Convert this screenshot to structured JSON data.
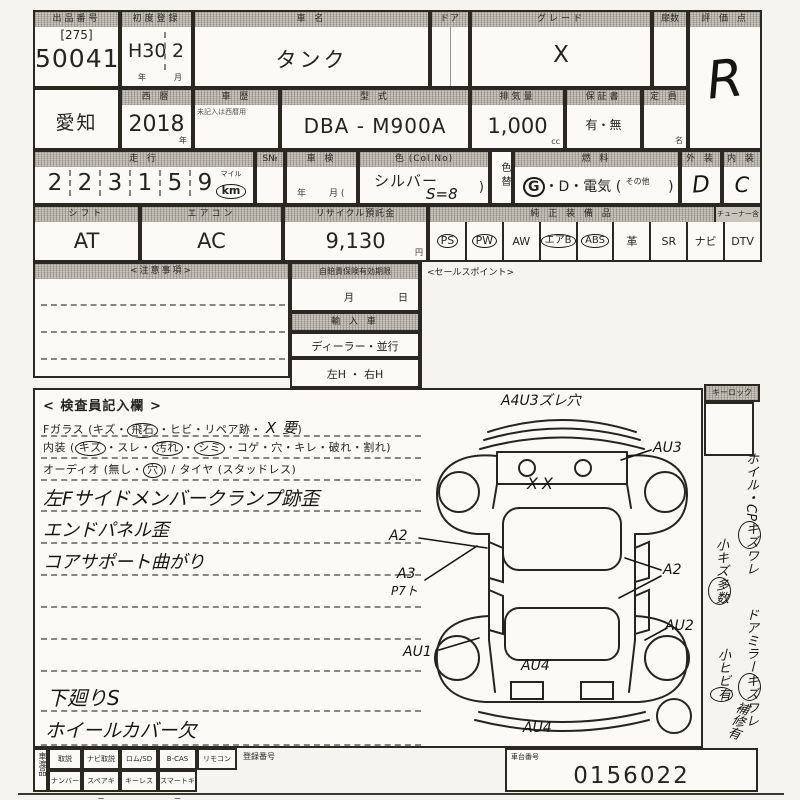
{
  "palette": {
    "ink": "#2b2822",
    "paper": "#f5f4ef",
    "cell": "#fbfaf6",
    "header_gray": "#c9c5bd",
    "handwriting": "#17150f"
  },
  "row1": {
    "auction_label": "出品番号",
    "auction_bracket": "[275]",
    "auction_no": "50041",
    "firstreg_label": "初度登録",
    "firstreg_year": "H30",
    "firstreg_month": "2",
    "year_unit": "年",
    "month_unit": "月",
    "carname_label": "車 名",
    "carname": "タンク",
    "door_label": "ドア",
    "grade_label": "グレード",
    "grade": "X",
    "doors_label": "扉数",
    "score_label": "評 価 点",
    "score": "R"
  },
  "row2": {
    "prefecture": "愛知",
    "seireki_label": "西 暦",
    "seireki": "2018",
    "year_unit": "年",
    "rireki_label": "車 歴",
    "rireki_note": "未記入は西暦用",
    "model_label": "型 式",
    "model": "DBA - M900A",
    "disp_label": "排気量",
    "disp": "1,000",
    "cc": "cc",
    "warranty_label": "保証書",
    "warranty": "有・無",
    "capacity_label": "定 員",
    "capacity_unit": "名"
  },
  "row3": {
    "mileage_label": "走 行",
    "digits": [
      "2",
      "2",
      "3",
      "1",
      "5",
      "9"
    ],
    "mile": "マイル",
    "km": "km",
    "s_label": "S№",
    "shaken_label": "車 検",
    "shaken_y": "年",
    "shaken_m": "月 (",
    "color_label": "色 (Col.No)",
    "color": "シルバー",
    "color_no": "S=8",
    "paren": ")",
    "colorchg_label": "色替",
    "fuel_label": "燃 料",
    "fuel_g": "G",
    "fuel_rest": "・D・電気 (",
    "fuel_other": "その他",
    "fuel_close": ")",
    "ext_label": "外 装",
    "ext": "D",
    "int_label": "内 装",
    "int": "C"
  },
  "row4": {
    "shift_label": "シフト",
    "shift": "AT",
    "aircon_label": "エアコン",
    "aircon": "AC",
    "recycle_label": "リサイクル預託金",
    "recycle": "9,130",
    "yen": "円",
    "equip_label": "純 正 装 備 品",
    "tuner_label": "チューナー含",
    "equipment": [
      {
        "label": "PS",
        "circled": true
      },
      {
        "label": "PW",
        "circled": true
      },
      {
        "label": "AW",
        "circled": false
      },
      {
        "label": "エアB",
        "circled": true
      },
      {
        "label": "ABS",
        "circled": true
      },
      {
        "label": "革",
        "circled": false
      },
      {
        "label": "SR",
        "circled": false
      },
      {
        "label": "ナビ",
        "circled": false
      },
      {
        "label": "DTV",
        "circled": false
      }
    ]
  },
  "row5": {
    "notes_label": "<注意事項>",
    "insurance_label": "自賠責保険有効期限",
    "month": "月",
    "day": "日",
    "import_label": "輸 入 車",
    "import_type": "ディーラー・並行",
    "handle": "左H ・ 右H",
    "sales_label": "<セールスポイント>"
  },
  "inspection": {
    "title": "< 検査員記入欄 >",
    "glass": [
      "Fガラス (キズ・",
      "飛石",
      "・ヒビ・リペア跡・",
      "X 要",
      ")"
    ],
    "naiso": [
      "内装 (",
      "キズ",
      "・スレ・",
      "汚れ",
      "・",
      "シミ",
      "・コゲ・穴・キレ・破れ・割れ)"
    ],
    "audio": [
      "オーディオ (無し・",
      "穴",
      ") / タイヤ (スタッドレス)"
    ],
    "notes": [
      "左Fサイドメンバークランプ跡歪",
      "エンドパネル歪",
      "コアサポート曲がり",
      "下廻りS",
      "ホイールカバー欠"
    ]
  },
  "diagram": {
    "top_note": "A4U3ズレ穴",
    "hood_mark": "XX",
    "au3": "AU3",
    "a2_left": "A2",
    "a3": "A3",
    "a3_sub": "P7ト",
    "au1": "AU1",
    "a2_right": "A2",
    "au2": "AU2",
    "au4_gate": "AU4",
    "au4_bumper": "AU4"
  },
  "sidebar": {
    "keylock": "キーロック",
    "items": [
      {
        "pre": "ホイル・CP",
        "circled": "キズ",
        "post": "ワレ"
      },
      {
        "pre": "小キズ",
        "circled": "多数",
        "post": ""
      },
      {
        "pre": "ドアミラー",
        "circled": "キズ",
        "post": "ワレ"
      },
      {
        "pre": "小ヒビ",
        "circled": "有",
        "post": ""
      },
      {
        "pre": "補修有",
        "circled": "",
        "post": ""
      }
    ]
  },
  "bottom": {
    "side_label": "車渡品",
    "row1": [
      "取説",
      "ナビ取説",
      "ロム/SD",
      "B-CAS",
      "リモコン"
    ],
    "row2": [
      "ナンバー",
      "スペアキー",
      "キーレス",
      "スマートキー"
    ],
    "reg_label": "登録番号",
    "chassis_label": "車台番号",
    "chassis_no": "0156022"
  }
}
